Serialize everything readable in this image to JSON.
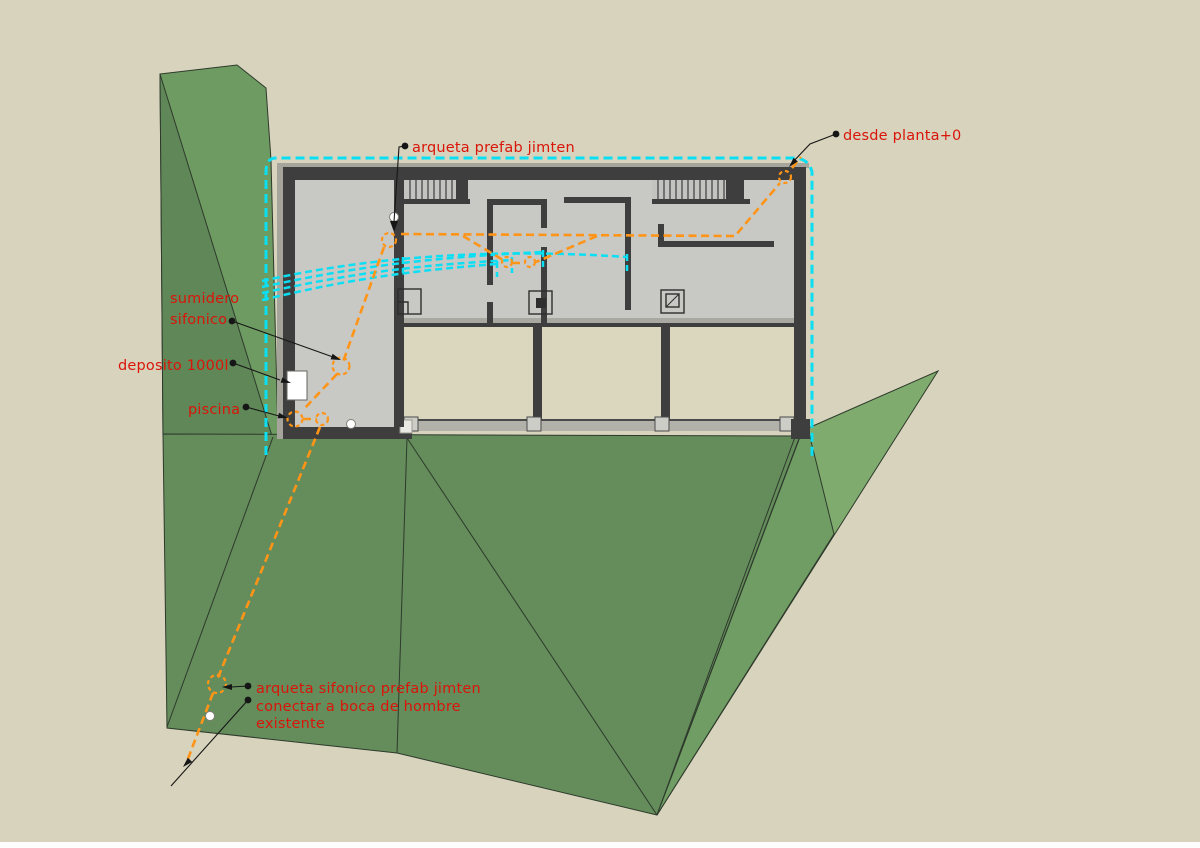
{
  "scene": {
    "type": "architectural-plan-annotation",
    "description_visible": "floor plan with terrain and dashed drainage pipes"
  },
  "annotations": {
    "arqueta_prefab": "arqueta prefab jimten",
    "desde_planta": "desde planta+0",
    "sumidero_l1": "sumidero",
    "sumidero_l2": "sifonico",
    "deposito": "deposito 1000l",
    "piscina": "piscina",
    "arqueta_sifonico": "arqueta sifonico prefab jimten",
    "conectar_l1": "conectar a boca de hombre",
    "conectar_l2": "existente"
  },
  "colors": {
    "background": "#d7d3bc",
    "bottom_strip": "#fdfdfd",
    "terrain_green_main": "#648d5b",
    "terrain_green_strip": "#6e9b61",
    "terrain_green_strip_dark": "#5f8757",
    "terrain_green_wing_light": "#7fac6e",
    "terrain_green_wing_mid": "#6f9d63",
    "floor_gray": "#c8c8c5",
    "wall_dark": "#3e3e3e",
    "band_beige": "#dbd7bf",
    "rail_gray": "#b2b2ab",
    "pipe_orange": "#ff9416",
    "pipe_cyan": "#0bdff4",
    "label_red": "#da150a",
    "deposito_white": "#ffffff"
  }
}
